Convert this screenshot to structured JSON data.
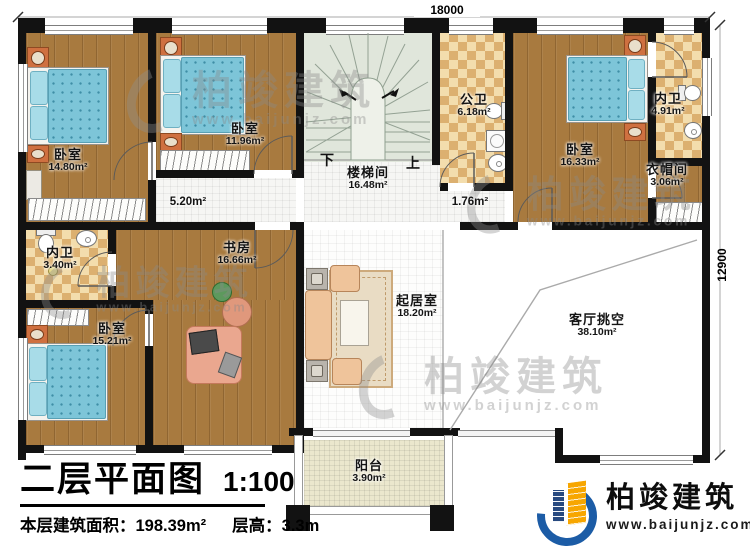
{
  "dimensions": {
    "top_width": "18000",
    "right_height": "12900"
  },
  "rooms": {
    "bedroom_tl": {
      "name": "卧室",
      "area": "14.80m²"
    },
    "bedroom_tm": {
      "name": "卧室",
      "area": "11.96m²"
    },
    "stairwell": {
      "name": "楼梯间",
      "area": "16.48m²",
      "down_label": "下",
      "up_label": "上"
    },
    "public_bath": {
      "name": "公卫",
      "area": "6.18m²"
    },
    "bedroom_tr": {
      "name": "卧室",
      "area": "16.33m²"
    },
    "ensuite_tr": {
      "name": "内卫",
      "area": "4.91m²"
    },
    "cloakroom": {
      "name": "衣帽间",
      "area": "3.06m²"
    },
    "hall_left": {
      "area": "5.20m²"
    },
    "hall_right": {
      "area": "1.76m²"
    },
    "ensuite_left": {
      "name": "内卫",
      "area": "3.40m²"
    },
    "study": {
      "name": "书房",
      "area": "16.66m²"
    },
    "bedroom_bl": {
      "name": "卧室",
      "area": "15.21m²"
    },
    "living_room": {
      "name": "起居室",
      "area": "18.20m²"
    },
    "void": {
      "name": "客厅挑空",
      "area": "38.10m²"
    },
    "balcony": {
      "name": "阳台",
      "area": "3.90m²"
    }
  },
  "title_block": {
    "title": "二层平面图",
    "scale": "1:100",
    "floor_area_label": "本层建筑面积：198.39m²",
    "floor_height_label": "层高：3.3m"
  },
  "brand": {
    "name": "柏竣建筑",
    "url": "www.baijunjz.com",
    "blue": "#1c5ca6",
    "orange": "#f7a600"
  },
  "watermark": {
    "name": "柏竣建筑",
    "url": "www.baijunjz.com"
  }
}
